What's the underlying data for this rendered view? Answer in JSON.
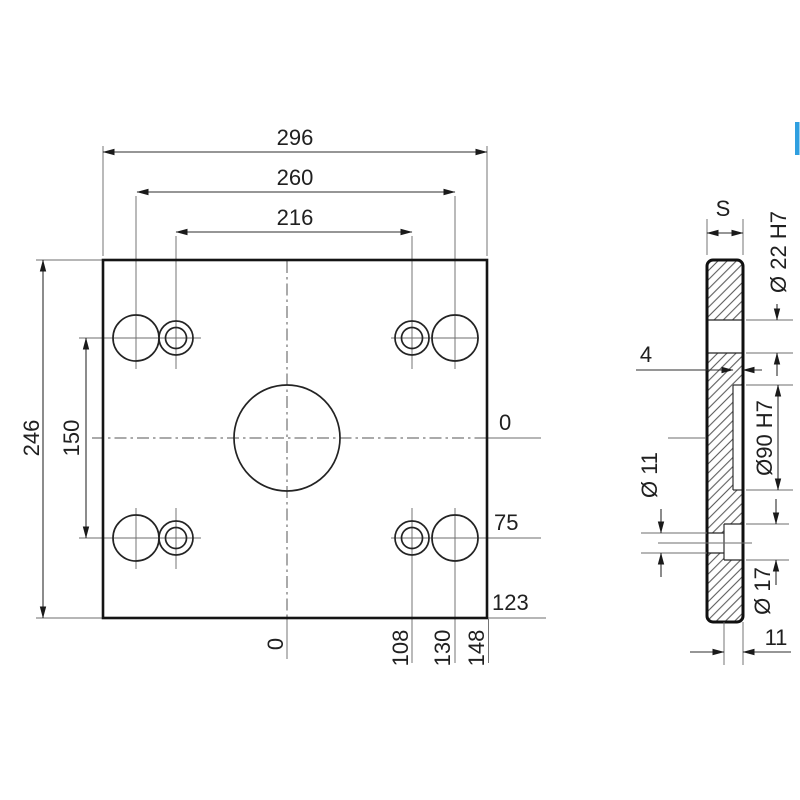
{
  "front_view": {
    "dim_outer_width": "296",
    "dim_hole_span_outer": "260",
    "dim_hole_span_inner": "216",
    "dim_outer_height": "246",
    "dim_hole_row_spacing": "150",
    "right_ordinates": {
      "zero": "0",
      "hole_row": "75",
      "bottom_edge": "123"
    },
    "bottom_ordinates": {
      "zero": "0",
      "inner_hole": "108",
      "outer_hole": "130",
      "right_edge": "148"
    }
  },
  "side_view": {
    "thickness": "S",
    "recess_depth": "4",
    "top_hole": "Ø 22 H7",
    "center_bore": "Ø90 H7",
    "through_hole": "Ø 11",
    "counterbore": "Ø 17",
    "counterbore_depth": "11"
  },
  "colors": {
    "object_line": "#141414",
    "thin_line": "#6e6e6e",
    "text": "#202020",
    "accent_blue": "#2f9fe0"
  }
}
